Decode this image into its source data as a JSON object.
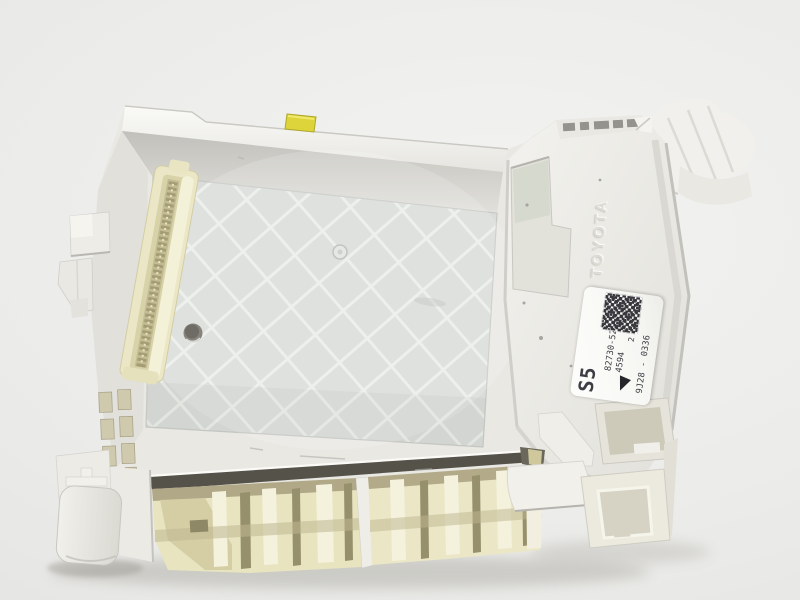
{
  "part_label": {
    "size_code": "S5",
    "part_number": "82730-52K40",
    "code": "4594",
    "count": "2",
    "serial": "9J28 - 0336"
  },
  "embossed_text": {
    "brand": "TOYOTA"
  },
  "icons": {
    "qr": "qr-code-icon",
    "direction_marker": "triangle-marker-icon"
  },
  "colors": {
    "background": "#ebebe9",
    "plastic_white": "#ecebe6",
    "plastic_cream": "#ebe7c6",
    "plate_gray": "#d9dcd9",
    "marker_yellow": "#ddd43c",
    "underside_shadow": "#55524a",
    "label_bg": "#fcfcfa",
    "label_text": "#3c3e44"
  }
}
